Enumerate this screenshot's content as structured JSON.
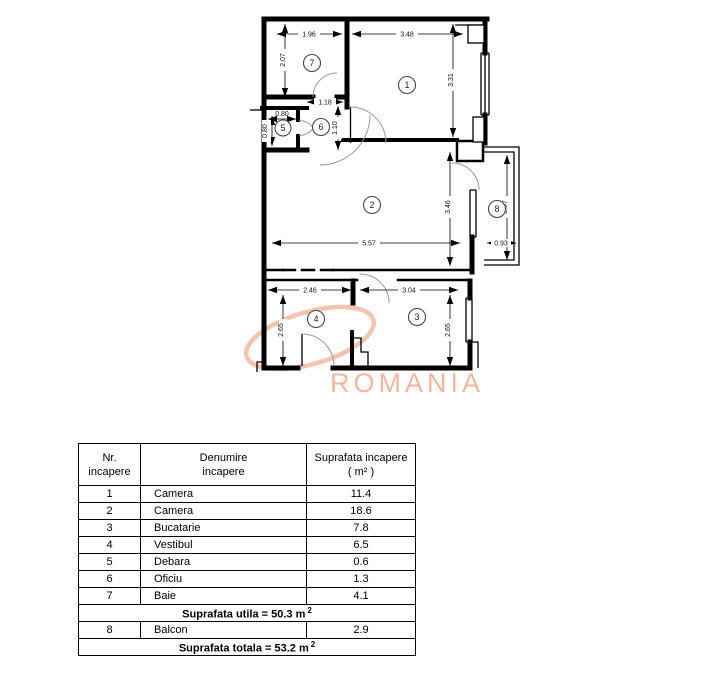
{
  "plan": {
    "watermark": "ROMANIA",
    "rooms": {
      "r1": "1",
      "r2": "2",
      "r3": "3",
      "r4": "4",
      "r5": "5",
      "r6": "6",
      "r7": "7",
      "r8": "8"
    },
    "dims": {
      "room7_width": "1.96",
      "room1_width": "3.48",
      "room7_height": "2.07",
      "room1_height": "3.31",
      "hall_width": "1.18",
      "hall_height": "1.10",
      "room5_width": "0.80",
      "room5_height": "0.80",
      "room2_width": "5.57",
      "room2_height": "3.46",
      "balcony_height": "3.07",
      "balcony_width": "0.93",
      "room4_width": "2.46",
      "room3_width": "3.04",
      "room4_height": "2.65",
      "room3_height": "2.65"
    }
  },
  "table": {
    "header": {
      "col1_line1": "Nr.",
      "col1_line2": "incapere",
      "col2_line1": "Denumire",
      "col2_line2": "incapere",
      "col3_line1": "Suprafata incapere",
      "col3_line2": "( m² )"
    },
    "rows": [
      {
        "nr": "1",
        "name": "Camera",
        "area": "11.4"
      },
      {
        "nr": "2",
        "name": "Camera",
        "area": "18.6"
      },
      {
        "nr": "3",
        "name": "Bucatarie",
        "area": "7.8"
      },
      {
        "nr": "4",
        "name": "Vestibul",
        "area": "6.5"
      },
      {
        "nr": "5",
        "name": "Debara",
        "area": "0.6"
      },
      {
        "nr": "6",
        "name": "Oficiu",
        "area": "1.3"
      },
      {
        "nr": "7",
        "name": "Baie",
        "area": "4.1"
      }
    ],
    "summary_utila": {
      "text": "Suprafata utila = 50.3 m",
      "sup": "2"
    },
    "balcony_row": {
      "nr": "8",
      "name": "Balcon",
      "area": "2.9"
    },
    "summary_totala": {
      "text": "Suprafata totala = 53.2 m",
      "sup": "2"
    }
  }
}
